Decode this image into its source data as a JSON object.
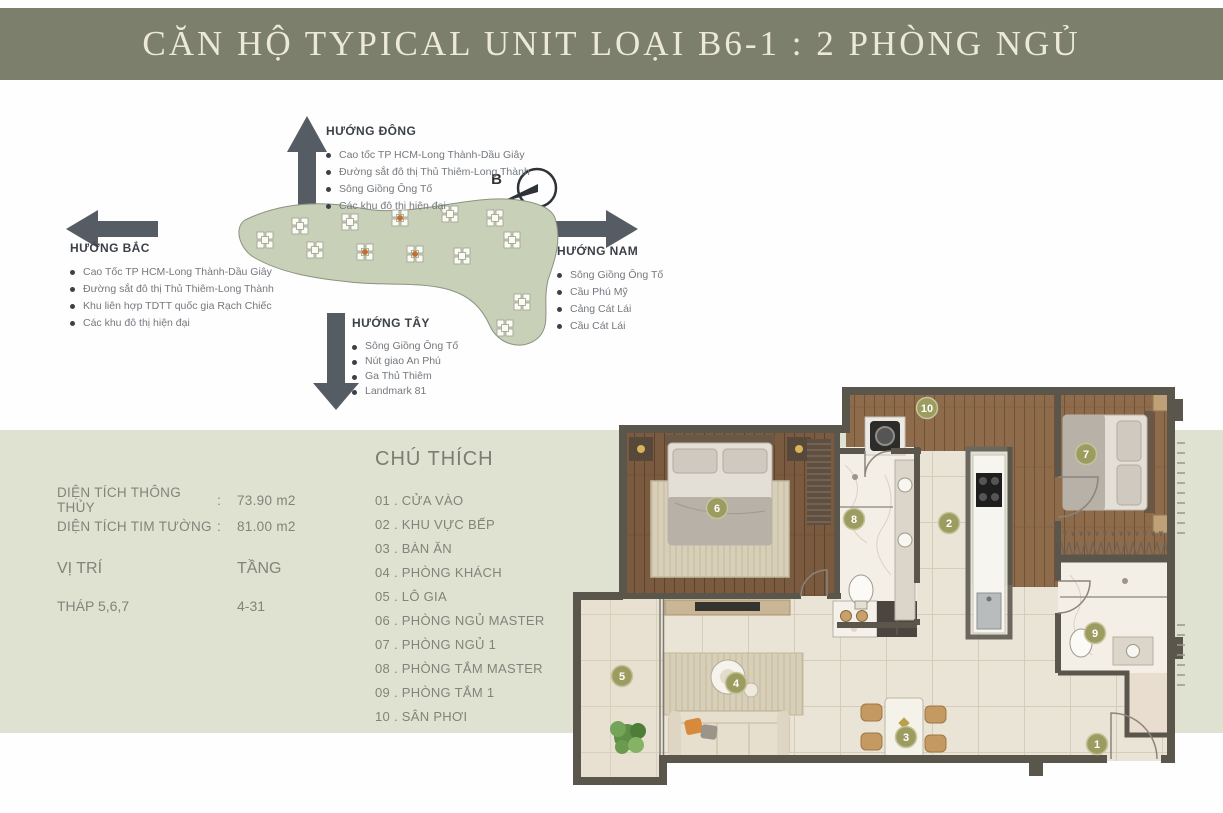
{
  "title": "CĂN HỘ TYPICAL UNIT LOẠI B6-1 : 2 PHÒNG NGỦ",
  "compass": {
    "north_short": "B",
    "east": {
      "title": "HƯỚNG ĐÔNG",
      "items": [
        "Cao tốc TP HCM-Long Thành-Dầu Giây",
        "Đường sắt đô thị Thủ Thiêm-Long Thành",
        "Sông Giồng Ông Tố",
        "Các khu đô thị hiện đại"
      ]
    },
    "north": {
      "title": "HƯỚNG BẮC",
      "items": [
        "Cao Tốc TP HCM-Long Thành-Dầu Giây",
        "Đường sắt đô thị Thủ Thiêm-Long Thành",
        "Khu liên hợp TDTT quốc gia Rạch Chiếc",
        "Các khu đô thị hiện đại"
      ]
    },
    "south": {
      "title": "HƯỚNG NAM",
      "items": [
        "Sông Giồng Ông Tố",
        "Cầu Phú Mỹ",
        "Cảng Cát Lái",
        "Cầu Cát Lái"
      ]
    },
    "west": {
      "title": "HƯỚNG TÂY",
      "items": [
        "Sông Giồng Ông Tố",
        "Nút giao An Phú",
        "Ga Thủ Thiêm",
        "Landmark 81"
      ]
    }
  },
  "info": {
    "rows": [
      {
        "label": "DIỆN TÍCH THÔNG THỦY",
        "sep": ":",
        "value": "73.90 m2"
      },
      {
        "label": "DIỆN TÍCH TIM TƯỜNG",
        "sep": ":",
        "value": "81.00 m2"
      }
    ],
    "position_label": "VỊ TRÍ",
    "floor_label": "TẦNG",
    "position_value": "THÁP 5,6,7",
    "floor_value": "4-31"
  },
  "legend": {
    "title": "CHÚ THÍCH",
    "items": [
      {
        "display": "01 . CỬA VÀO"
      },
      {
        "display": "02 . KHU VỰC BẾP"
      },
      {
        "display": "03 . BÀN ĂN"
      },
      {
        "display": "04 . PHÒNG KHÁCH"
      },
      {
        "display": "05 . LÔ GIA"
      },
      {
        "display": "06 . PHÒNG NGỦ MASTER"
      },
      {
        "display": "07 . PHÒNG NGỦ 1"
      },
      {
        "display": "08 . PHÒNG TẮM MASTER"
      },
      {
        "display": "09 . PHÒNG TẮM 1"
      },
      {
        "display": "10 . SÂN PHƠI"
      }
    ]
  },
  "plan": {
    "markers": [
      "1",
      "2",
      "3",
      "4",
      "5",
      "6",
      "7",
      "8",
      "9",
      "10"
    ]
  },
  "colors": {
    "banner": "#7b7f6c",
    "band": "#dfe2d1",
    "marker": "#9d9c60",
    "wall": "#5b564c",
    "wood_dark": "#7b5b3f",
    "wood_mid": "#8d6b4b",
    "tile": "#eae4d7",
    "marble": "#f3efe6",
    "sitemap_green": "#c9d0b8",
    "arrow": "#565c63",
    "accent_orange": "#c0702f"
  }
}
